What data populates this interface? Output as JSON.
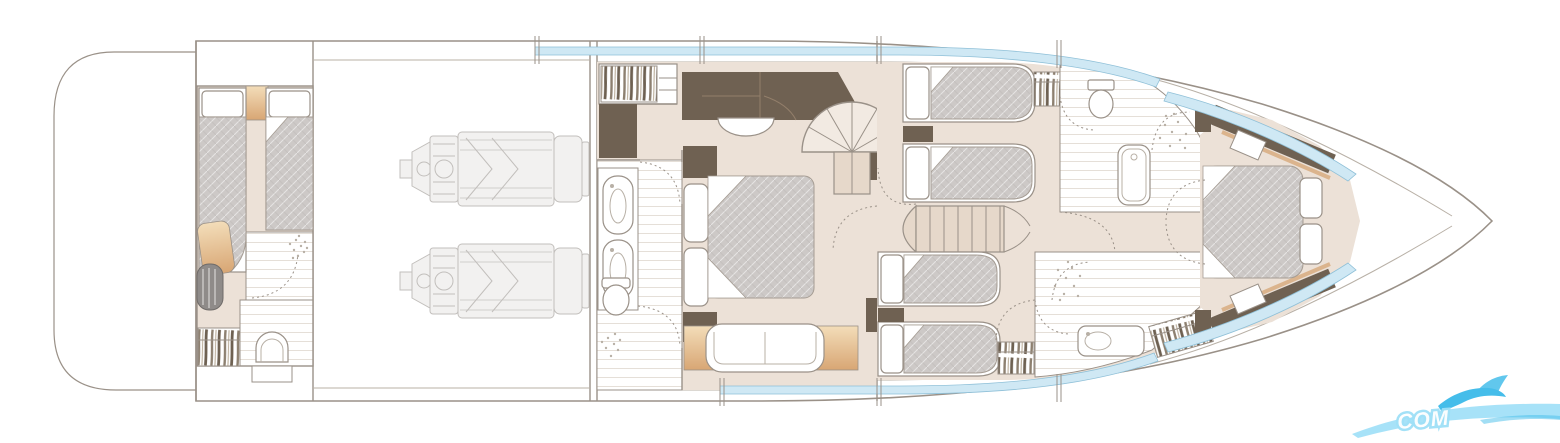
{
  "meta": {
    "description": "Motor yacht lower-deck accommodation floor plan, line drawing, no labels",
    "canvas": {
      "width": 1560,
      "height": 443
    }
  },
  "colors": {
    "background": "#ffffff",
    "outline": "#9a9188",
    "outline_light": "#b8b0a6",
    "floor_beige": "#ece1d7",
    "floor_beige_dark": "#e6d8ca",
    "wall_dark_brown": "#6f6152",
    "wood_tan": "#d9af85",
    "mattress_gray": "#cdc9c7",
    "mattress_stroke": "#a59c93",
    "engine_line": "#c2bfbc",
    "engine_fill": "#f2f1f0",
    "window_blue": "#cfe8f4",
    "window_blue_stroke": "#8fc0d8",
    "plank_line": "#ddd5cb",
    "appliance_gray": "#8f8b89",
    "watermark_blue_light": "#9fe0f7",
    "watermark_blue_dark": "#45bdea",
    "watermark_text": "#ffffff"
  },
  "watermark": {
    "text": "COM"
  },
  "plan": {
    "vessel": "motor-yacht-lower-deck",
    "rooms": [
      {
        "name": "swim-platform",
        "fixtures": []
      },
      {
        "name": "crew-cabin",
        "fixtures": [
          "single-berth",
          "single-berth",
          "wardrobe",
          "washer",
          "toilet",
          "shower"
        ]
      },
      {
        "name": "engine-room",
        "fixtures": [
          "engine-port",
          "engine-starboard"
        ]
      },
      {
        "name": "master-cabin",
        "fixtures": [
          "double-bed",
          "nightstands",
          "wardrobe",
          "dresser",
          "stool",
          "sofa"
        ]
      },
      {
        "name": "master-bathroom",
        "fixtures": [
          "twin-sinks",
          "toilet",
          "shower"
        ]
      },
      {
        "name": "spiral-staircase",
        "fixtures": []
      },
      {
        "name": "guest-cabin-starboard",
        "fixtures": [
          "single-bed",
          "single-bed",
          "wardrobe"
        ]
      },
      {
        "name": "guest-cabin-port",
        "fixtures": [
          "single-bed",
          "single-bed",
          "wardrobe"
        ]
      },
      {
        "name": "staircase",
        "fixtures": []
      },
      {
        "name": "forward-bathroom-starboard",
        "fixtures": [
          "toilet",
          "bathtub",
          "shower"
        ]
      },
      {
        "name": "forward-bathroom-port",
        "fixtures": [
          "washbasin",
          "shower",
          "wardrobe"
        ]
      },
      {
        "name": "vip-cabin-bow",
        "fixtures": [
          "double-bed",
          "pillows",
          "side-shelves"
        ]
      }
    ]
  }
}
